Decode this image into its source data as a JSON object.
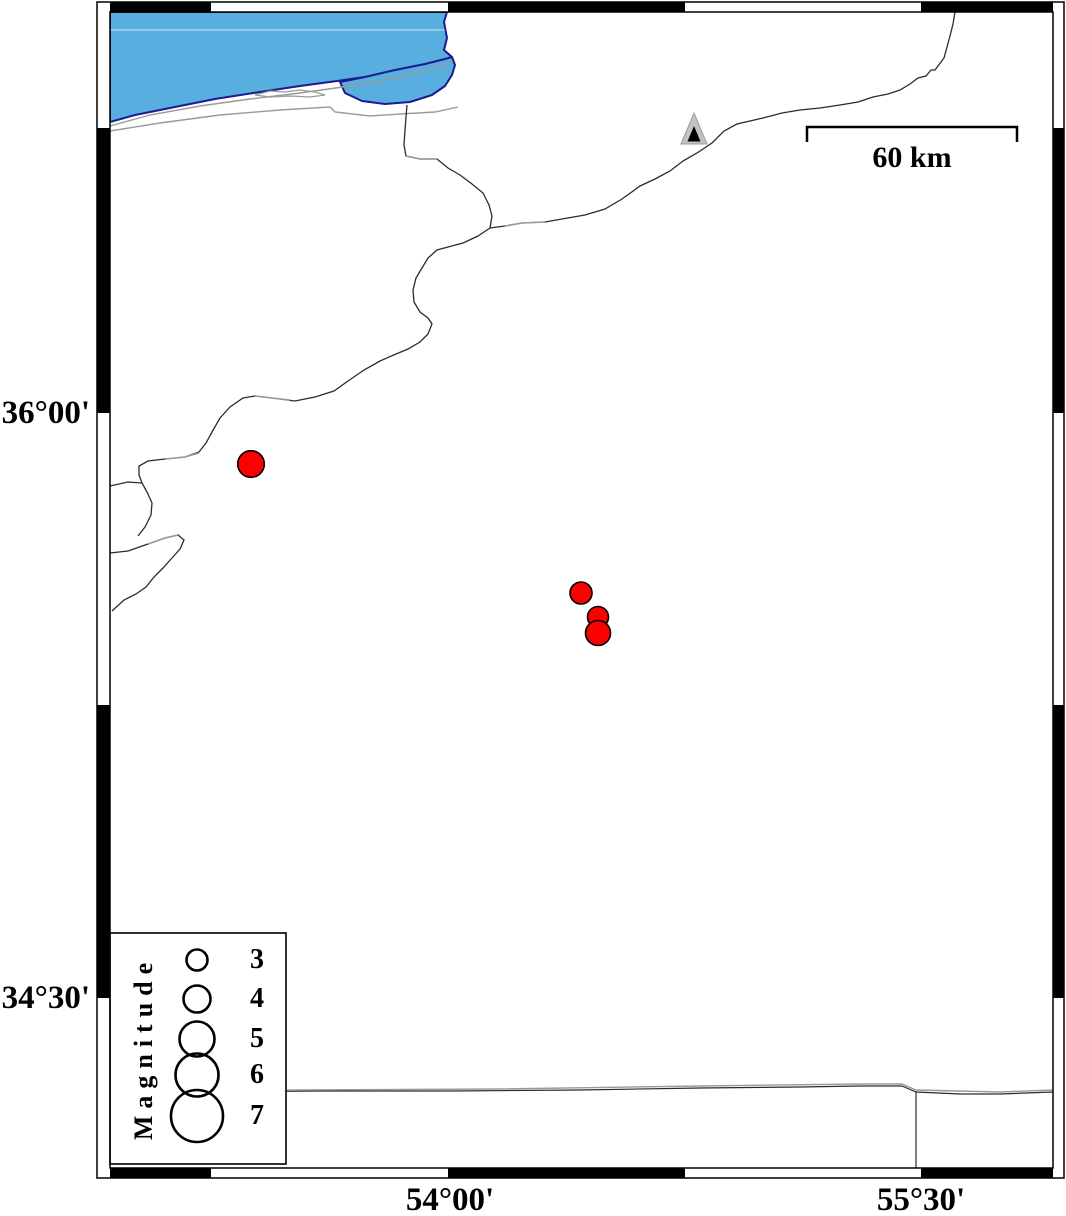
{
  "map": {
    "description": "seismicity map",
    "axis": {
      "left_labels": [
        {
          "text": "36°00'",
          "y_px": 413
        },
        {
          "text": "34°30'",
          "y_px": 998
        }
      ],
      "bottom_labels": [
        {
          "text": "54°00'",
          "x_px": 448
        },
        {
          "text": "55°30'",
          "x_px": 921
        }
      ],
      "lon_range_deg": [
        52.93,
        55.92
      ],
      "lat_range_deg": [
        34.06,
        37.03
      ],
      "tick_interval": "45 arc-minutes (alternating black/white frame segments)"
    },
    "scale_bar": {
      "label": "60 km",
      "length_px": 210
    },
    "legend": {
      "title": "Magnitude",
      "entries": [
        {
          "magnitude": "3",
          "radius_px": 10.5,
          "cy_px": 960
        },
        {
          "magnitude": "4",
          "radius_px": 13.5,
          "cy_px": 999
        },
        {
          "magnitude": "5",
          "radius_px": 17.5,
          "cy_px": 1039
        },
        {
          "magnitude": "6",
          "radius_px": 21.5,
          "cy_px": 1075
        },
        {
          "magnitude": "7",
          "radius_px": 26.0,
          "cy_px": 1116
        }
      ],
      "circle_cx_px": 197
    },
    "earthquakes": [
      {
        "x_px": 251,
        "y_px": 464,
        "r_px": 13.3,
        "approx_lon": 53.38,
        "approx_lat": 35.87,
        "approx_magnitude": 3.7
      },
      {
        "x_px": 581,
        "y_px": 593,
        "r_px": 11.0,
        "approx_lon": 54.42,
        "approx_lat": 35.54,
        "approx_magnitude": 3.2
      },
      {
        "x_px": 598,
        "y_px": 617,
        "r_px": 10.5,
        "approx_lon": 54.47,
        "approx_lat": 35.48,
        "approx_magnitude": 3.0
      },
      {
        "x_px": 598,
        "y_px": 633,
        "r_px": 12.5,
        "approx_lon": 54.47,
        "approx_lat": 35.44,
        "approx_magnitude": 3.5
      }
    ],
    "station_triangle": {
      "x_px": 694,
      "y_px": 136,
      "approx_lon": 54.78,
      "approx_lat": 36.71
    },
    "colors": {
      "sea": "#58AEDE",
      "sea-outline": "#1b1b8e",
      "eq-red": "#fb0000",
      "triangle-gray": "#c3c3c3",
      "line-black": "#2b2b2b",
      "line-gray": "#9a9a9a"
    }
  }
}
